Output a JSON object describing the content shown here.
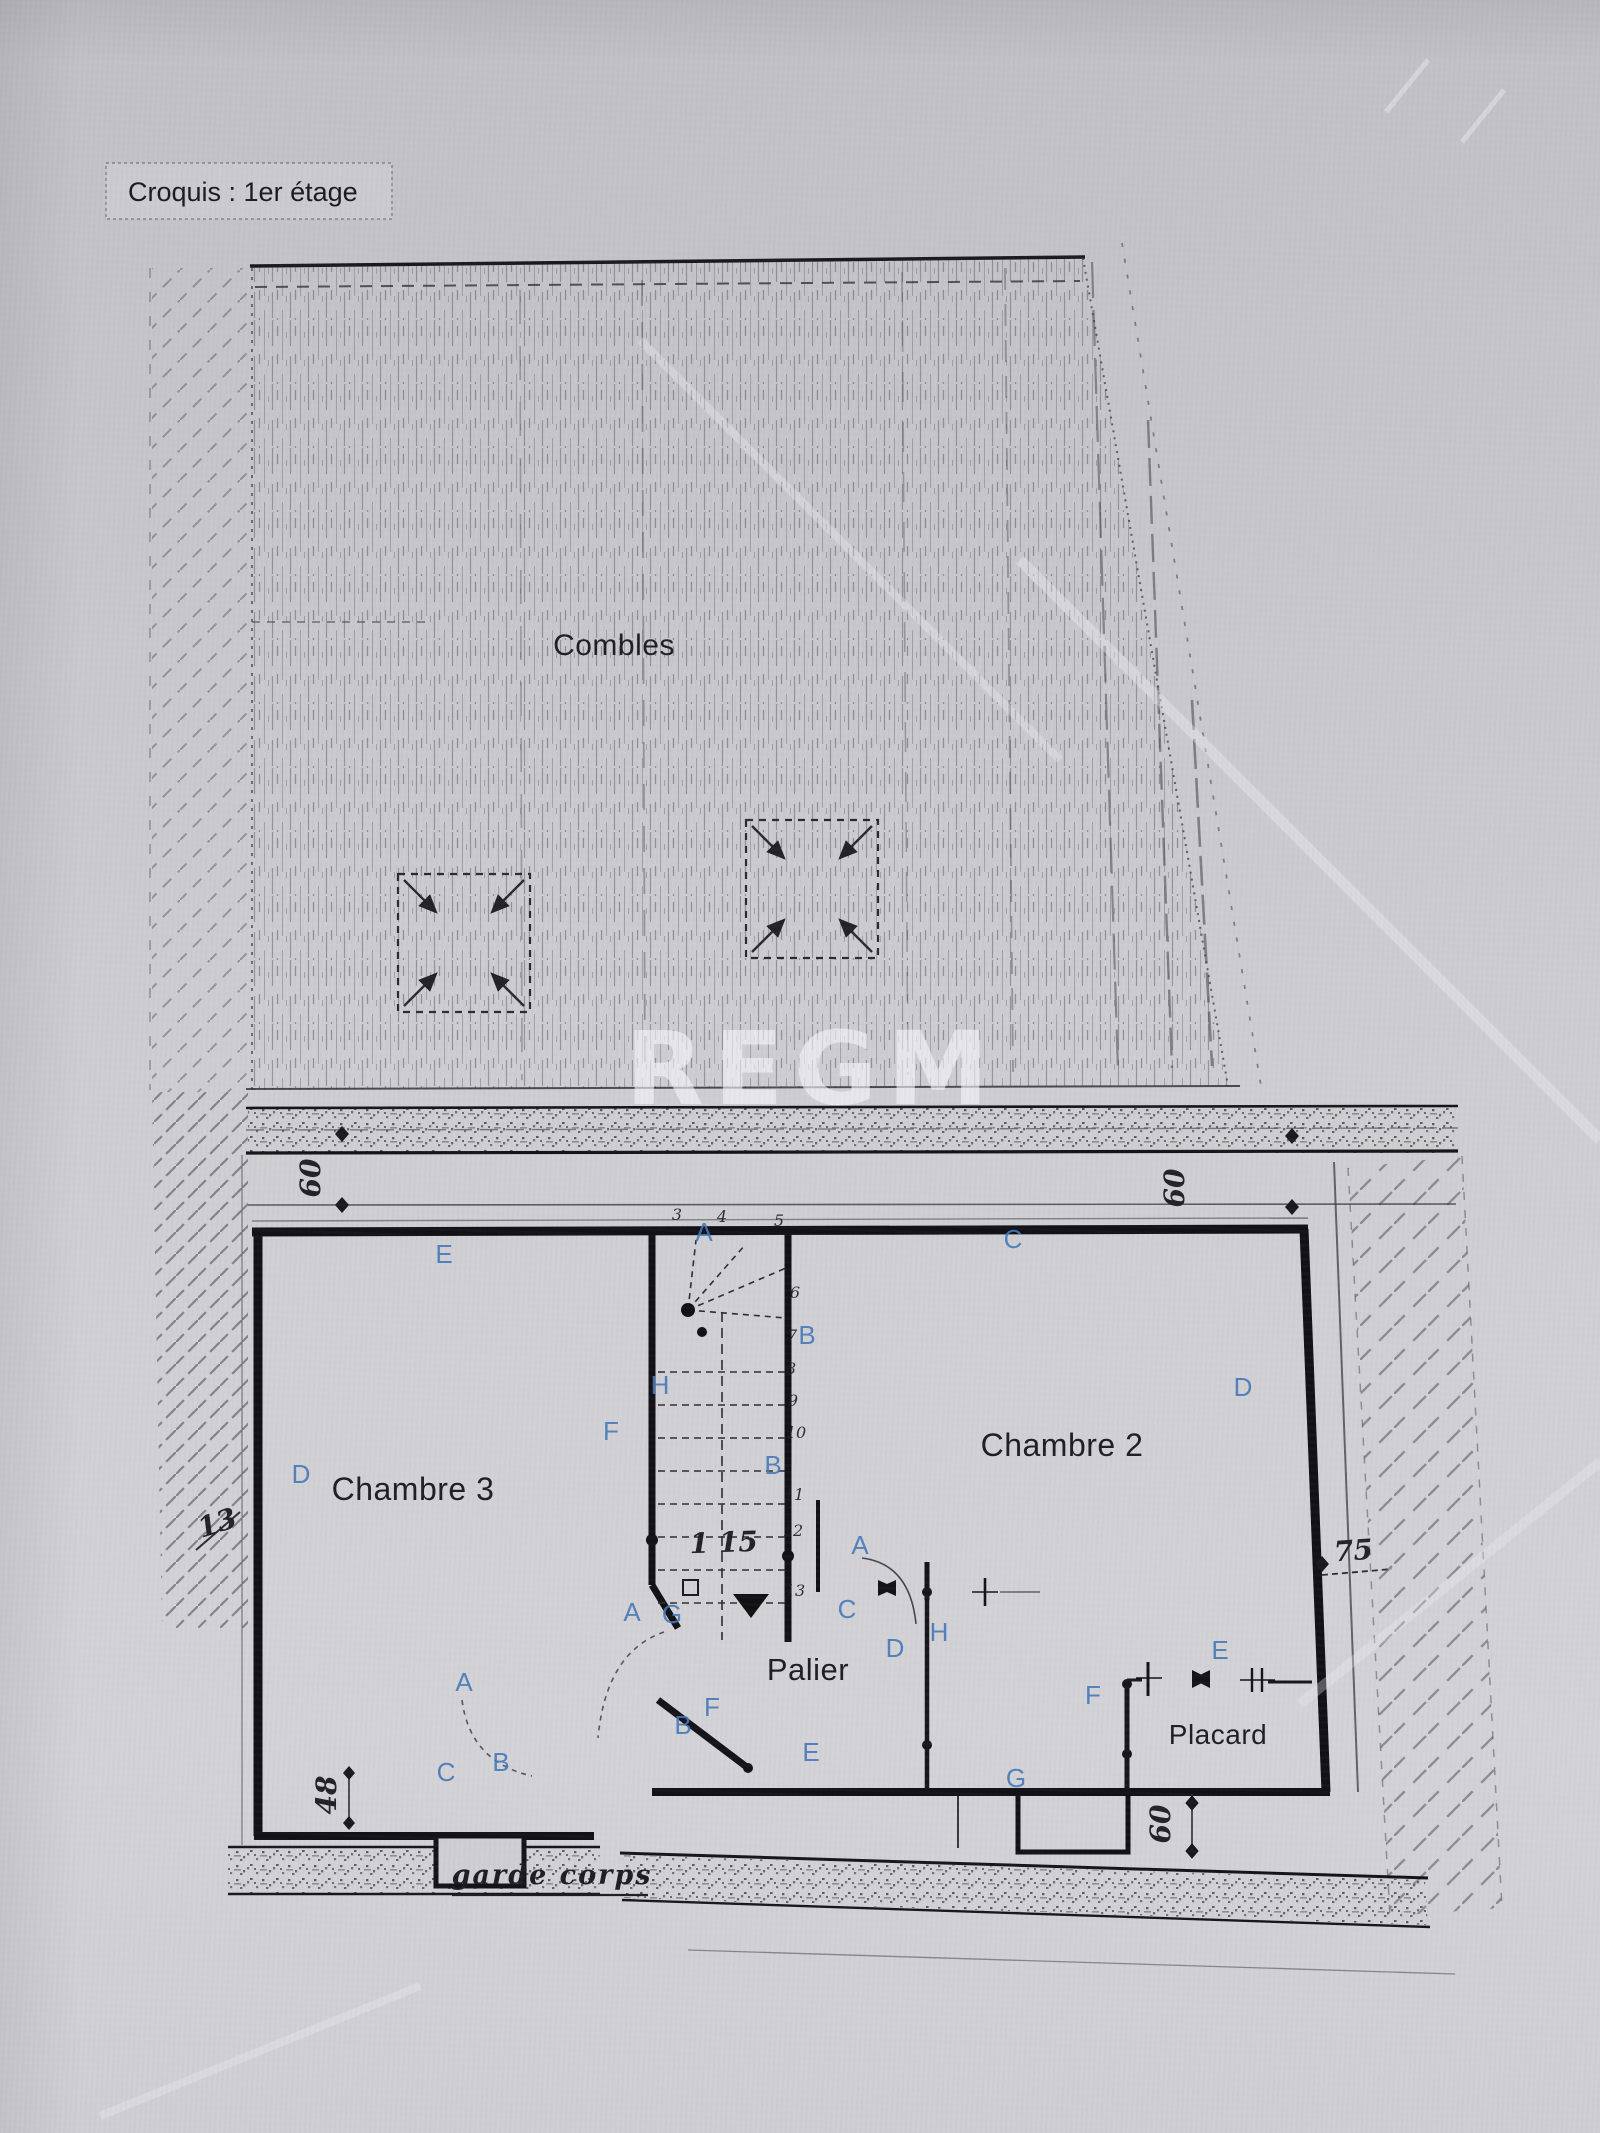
{
  "document": {
    "title_box": "Croquis : 1er étage",
    "watermark": "REGM",
    "rooms": [
      {
        "label": "Combles",
        "x": 614,
        "y": 655,
        "size": 30
      },
      {
        "label": "Chambre 3",
        "x": 413,
        "y": 1500,
        "size": 32
      },
      {
        "label": "Chambre 2",
        "x": 1062,
        "y": 1456,
        "size": 32
      },
      {
        "label": "Palier",
        "x": 808,
        "y": 1680,
        "size": 31
      },
      {
        "label": "Placard",
        "x": 1218,
        "y": 1744,
        "size": 28
      }
    ],
    "wall_letters": [
      {
        "t": "E",
        "x": 444,
        "y": 1263
      },
      {
        "t": "A",
        "x": 704,
        "y": 1241
      },
      {
        "t": "C",
        "x": 1013,
        "y": 1248
      },
      {
        "t": "B",
        "x": 807,
        "y": 1344
      },
      {
        "t": "H",
        "x": 660,
        "y": 1394
      },
      {
        "t": "D",
        "x": 1243,
        "y": 1396
      },
      {
        "t": "F",
        "x": 611,
        "y": 1440
      },
      {
        "t": "B",
        "x": 773,
        "y": 1474
      },
      {
        "t": "D",
        "x": 301,
        "y": 1483
      },
      {
        "t": "A",
        "x": 860,
        "y": 1554
      },
      {
        "t": "C",
        "x": 847,
        "y": 1618
      },
      {
        "t": "A",
        "x": 632,
        "y": 1621
      },
      {
        "t": "G",
        "x": 672,
        "y": 1623
      },
      {
        "t": "H",
        "x": 939,
        "y": 1641
      },
      {
        "t": "D",
        "x": 895,
        "y": 1657
      },
      {
        "t": "E",
        "x": 1220,
        "y": 1659
      },
      {
        "t": "A",
        "x": 464,
        "y": 1691
      },
      {
        "t": "F",
        "x": 1093,
        "y": 1704
      },
      {
        "t": "F",
        "x": 712,
        "y": 1716
      },
      {
        "t": "B",
        "x": 683,
        "y": 1734
      },
      {
        "t": "E",
        "x": 811,
        "y": 1761
      },
      {
        "t": "B",
        "x": 501,
        "y": 1771
      },
      {
        "t": "C",
        "x": 446,
        "y": 1781
      },
      {
        "t": "G",
        "x": 1016,
        "y": 1787
      }
    ],
    "stair_numbers": [
      {
        "t": "3",
        "x": 677,
        "y": 1220
      },
      {
        "t": "4",
        "x": 722,
        "y": 1222
      },
      {
        "t": "5",
        "x": 779,
        "y": 1226
      },
      {
        "t": "6",
        "x": 795,
        "y": 1298
      },
      {
        "t": "7",
        "x": 792,
        "y": 1341
      },
      {
        "t": "8",
        "x": 791,
        "y": 1374
      },
      {
        "t": "9",
        "x": 793,
        "y": 1406
      },
      {
        "t": "10",
        "x": 796,
        "y": 1438
      },
      {
        "t": "11",
        "x": 794,
        "y": 1500
      },
      {
        "t": "12",
        "x": 793,
        "y": 1536
      },
      {
        "t": "13",
        "x": 795,
        "y": 1596
      }
    ],
    "dimensions": [
      {
        "t": "60",
        "x": 320,
        "y": 1178,
        "rot": -90
      },
      {
        "t": "60",
        "x": 1184,
        "y": 1188,
        "rot": -90
      },
      {
        "t": "60",
        "x": 1170,
        "y": 1824,
        "rot": -90
      },
      {
        "t": "48",
        "x": 336,
        "y": 1795,
        "rot": -90
      },
      {
        "t": "13",
        "x": 220,
        "y": 1532,
        "rot": -18,
        "size": 30
      },
      {
        "t": "75",
        "x": 1354,
        "y": 1560,
        "rot": -4,
        "size": 32
      },
      {
        "t": "1 15",
        "x": 724,
        "y": 1552,
        "rot": -2,
        "size": 44
      }
    ],
    "annotations": [
      {
        "t": "garde corps",
        "x": 552,
        "y": 1884
      }
    ]
  },
  "colors": {
    "paper": "#c9c9cd",
    "ink": "#141418",
    "blue_letter": "#4579b8",
    "hatch": "#55555c",
    "watermark": "#f6f6fa"
  }
}
